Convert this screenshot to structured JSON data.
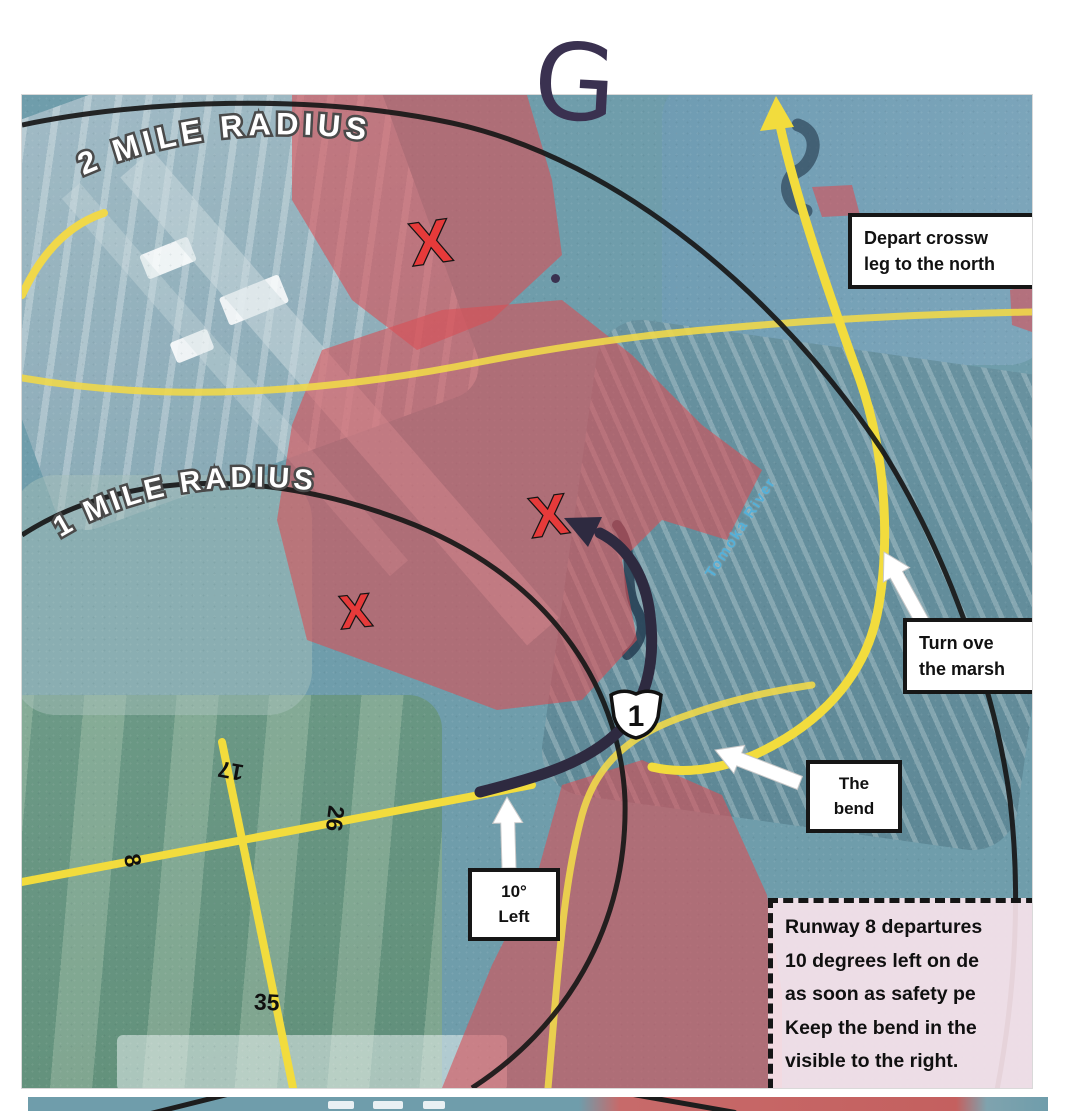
{
  "annotations": {
    "handwritten_letter": "G",
    "radius_labels": {
      "outer": "2 MILE RADIUS",
      "inner": "1 MILE RADIUS"
    },
    "x_mark": "X",
    "callouts": {
      "depart": {
        "line1": "Depart crossw",
        "line2": "leg to the north"
      },
      "turn": {
        "line1": "Turn ove",
        "line2": "the marsh"
      },
      "bend": {
        "line1": "The",
        "line2": "bend"
      },
      "left10": {
        "line1": "10°",
        "line2": "Left"
      }
    },
    "procedure_note": {
      "lines": [
        "Runway 8 departures",
        "10 degrees left on de",
        "as soon as safety pe",
        "Keep the bend in the",
        "visible to the right."
      ]
    }
  },
  "map": {
    "river_label": "Tomoka River",
    "highway_shield": "1",
    "runway_labels": {
      "rwy8": "8",
      "rwy26": "26",
      "rwy17": "17",
      "rwy35": "35"
    }
  },
  "colors": {
    "noise_area_red": "#d94f55",
    "route_yellow": "#f2dc3d",
    "ink_navy": "#2e2a40",
    "river_blue": "#55b0d8",
    "map_teal": "#6f9dab"
  }
}
